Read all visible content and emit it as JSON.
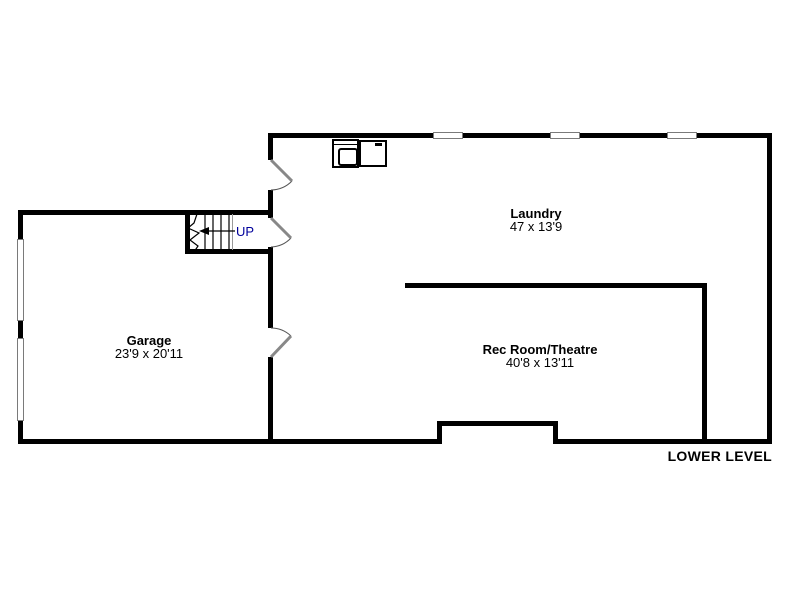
{
  "title": "Lower level floor plan",
  "footer": {
    "label": "LOWER LEVEL"
  },
  "rooms": {
    "laundry": {
      "name": "Laundry",
      "dims": "47 x 13'9"
    },
    "garage": {
      "name": "Garage",
      "dims": "23'9 x 20'11"
    },
    "rec_room": {
      "name": "Rec Room/Theatre",
      "dims": "40'8 x 13'11"
    }
  },
  "stairs": {
    "label": "UP",
    "icon": "up-arrow-icon"
  },
  "fixtures": {
    "sink": "laundry-sink",
    "washer": "washer-appliance"
  },
  "features": {
    "windows_top_wall": 3,
    "garage_doors_left_wall": 2,
    "interior_doors": 3
  },
  "colors": {
    "wall": "#000000",
    "background": "#ffffff",
    "up_label": "#00009b",
    "window_border": "#7a7a7a",
    "door_leaf": "#888888",
    "door_arc": "#555555"
  }
}
